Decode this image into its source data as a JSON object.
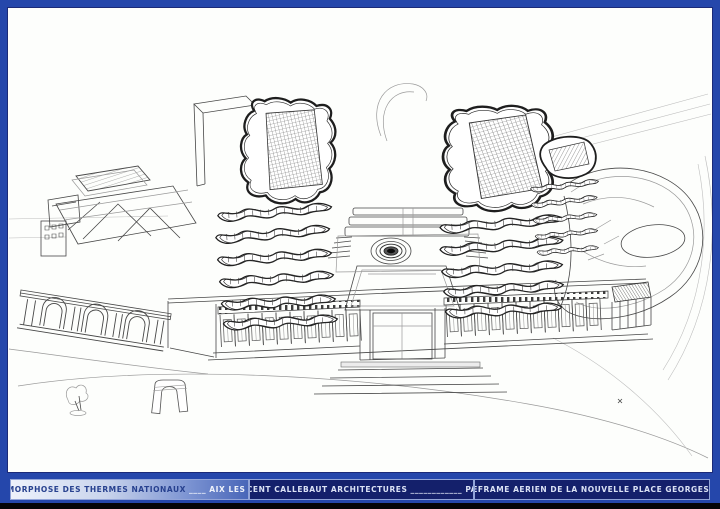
{
  "title_block": {
    "project_left": "METAMORPHOSE DES THERMES NATIONAUX",
    "project_right": "____ AIX LES BAINS",
    "firm": "VINCENT CALLEBAUT ARCHITECTURES ____________ PARIS",
    "drawing_title": "WIREFRAME AERIEN  DE LA NOUVELLE PLACE GEORGES 1ER"
  },
  "colors": {
    "frame_blue": "#2547ab",
    "bar_navy": "#14206b",
    "strip_black": "#050508",
    "cell_border": "#92a4d8",
    "text_light": "#dbe2f5",
    "text_dark": "#27418f",
    "paper": "#fdfefc"
  },
  "drawing": {
    "description": "Aerial wireframe perspective of the new Place Georges 1er: historic thermes building at left, two organic stacked towers with gridded roofs, neoclassical facade and plaza with circular fountain, landscaped mound at right"
  }
}
